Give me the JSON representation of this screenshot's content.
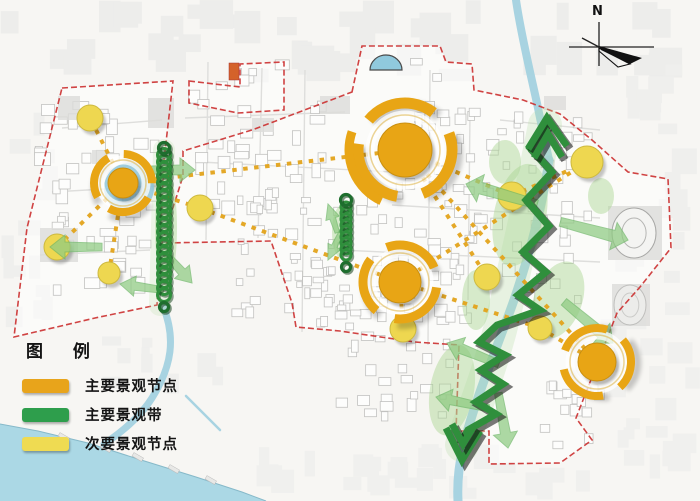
{
  "legend": {
    "title": "图 例",
    "items": [
      {
        "id": "main-landscape-node",
        "label": "主要景观节点",
        "color": "#E8A41B"
      },
      {
        "id": "main-landscape-belt",
        "label": "主要景观带",
        "color": "#2E9E4C"
      },
      {
        "id": "secondary-landscape-node",
        "label": "次要景观节点",
        "color": "#EFDB52"
      }
    ]
  },
  "compass": {
    "label": "N"
  },
  "colors": {
    "main_node": "#E8A515",
    "node_edge": "#C98F10",
    "secondary_node": "#EED750",
    "secondary_edge": "#CDB93E",
    "belt_green": "#2F8F3C",
    "belt_dark": "#14401C",
    "arrow_green": "#8FCB82",
    "park_green": "#A9D491",
    "connector": "#E3A41C",
    "boundary_red": "#CC3333",
    "water": "#ABD8E5",
    "river": "#9ECFDF",
    "building_stroke": "#C2C2C0",
    "background": "#F7F6F3"
  },
  "map": {
    "main_nodes": [
      {
        "x": 405,
        "y": 150,
        "r": 27,
        "ring_r": 47,
        "ring_w": 11,
        "dash": [
          72,
          26
        ],
        "rot": -20,
        "extra": true
      },
      {
        "x": 123,
        "y": 183,
        "r": 15,
        "ring_r": 29,
        "ring_w": 8,
        "dash": [
          45,
          16
        ],
        "rot": 30,
        "water_backing": true
      },
      {
        "x": 400,
        "y": 282,
        "r": 21,
        "ring_r": 37,
        "ring_w": 9,
        "dash": [
          57,
          20
        ],
        "rot": 10
      },
      {
        "x": 597,
        "y": 362,
        "r": 19,
        "ring_r": 34,
        "ring_w": 8,
        "dash": [
          52,
          19
        ],
        "rot": -40
      }
    ],
    "secondary_nodes": [
      [
        90,
        118,
        13
      ],
      [
        57,
        247,
        13
      ],
      [
        109,
        273,
        11
      ],
      [
        200,
        208,
        13
      ],
      [
        512,
        196,
        14
      ],
      [
        487,
        277,
        13
      ],
      [
        540,
        328,
        12
      ],
      [
        587,
        162,
        16
      ],
      [
        403,
        329,
        13
      ]
    ],
    "connectors": [
      [
        123,
        183,
        405,
        150
      ],
      [
        123,
        183,
        90,
        118
      ],
      [
        123,
        183,
        57,
        247
      ],
      [
        123,
        183,
        109,
        273
      ],
      [
        123,
        183,
        200,
        208
      ],
      [
        200,
        208,
        400,
        282
      ],
      [
        405,
        150,
        512,
        196
      ],
      [
        512,
        196,
        587,
        162
      ],
      [
        405,
        150,
        597,
        362
      ],
      [
        405,
        150,
        487,
        277
      ],
      [
        400,
        282,
        587,
        162
      ],
      [
        400,
        282,
        540,
        328
      ],
      [
        540,
        328,
        597,
        362
      ],
      [
        400,
        282,
        403,
        329
      ]
    ],
    "coils": [
      {
        "x": 164,
        "y0": 155,
        "y1": 300,
        "r": 6.5,
        "step": 7
      },
      {
        "x": 346,
        "y0": 207,
        "y1": 260,
        "r": 5,
        "step": 6
      }
    ],
    "zigzag": {
      "points": [
        [
          548,
          122
        ],
        [
          530,
          148
        ],
        [
          552,
          172
        ],
        [
          526,
          200
        ],
        [
          549,
          226
        ],
        [
          523,
          252
        ],
        [
          546,
          272
        ],
        [
          518,
          295
        ],
        [
          540,
          310
        ],
        [
          497,
          325
        ],
        [
          479,
          342
        ],
        [
          505,
          355
        ],
        [
          481,
          370
        ],
        [
          503,
          384
        ],
        [
          476,
          402
        ],
        [
          496,
          414
        ],
        [
          468,
          430
        ],
        [
          460,
          444
        ]
      ],
      "head_top": [
        [
          [
            528,
            149
          ],
          [
            547,
            118
          ],
          [
            567,
            146
          ]
        ],
        [
          [
            534,
            158
          ],
          [
            548,
            134
          ],
          [
            562,
            157
          ]
        ]
      ],
      "head_bottom": [
        [
          [
            446,
            428
          ],
          [
            462,
            460
          ],
          [
            480,
            431
          ]
        ],
        [
          [
            452,
            424
          ],
          [
            463,
            444
          ],
          [
            474,
            426
          ]
        ]
      ]
    },
    "green_bands": [
      {
        "d": "M545,125 C530,200 515,270 500,330 C485,385 470,420 462,445",
        "w": 34,
        "o": 0.28
      },
      {
        "d": "M164,150 L160,305",
        "w": 22,
        "o": 0.22
      }
    ],
    "arrows": [
      [
        195,
        170,
        0,
        48,
        12
      ],
      [
        50,
        247,
        180,
        52,
        12
      ],
      [
        192,
        283,
        48,
        40,
        10
      ],
      [
        120,
        284,
        188,
        44,
        10
      ],
      [
        328,
        204,
        252,
        30,
        7
      ],
      [
        328,
        260,
        115,
        30,
        7
      ],
      [
        466,
        184,
        196,
        74,
        14
      ],
      [
        628,
        240,
        15,
        70,
        14
      ],
      [
        447,
        343,
        202,
        56,
        12
      ],
      [
        613,
        343,
        40,
        64,
        13
      ],
      [
        436,
        397,
        192,
        54,
        11
      ],
      [
        508,
        448,
        80,
        56,
        12
      ]
    ],
    "parks": [
      [
        520,
        215,
        26,
        52,
        12
      ],
      [
        558,
        300,
        24,
        40,
        20
      ],
      [
        452,
        390,
        22,
        46,
        10
      ],
      [
        505,
        162,
        16,
        22,
        0
      ],
      [
        341,
        232,
        9,
        26,
        0
      ],
      [
        166,
        228,
        11,
        58,
        0
      ],
      [
        601,
        196,
        13,
        18,
        0
      ],
      [
        476,
        300,
        14,
        30,
        0
      ]
    ],
    "rivers": [
      {
        "d": "M516,0 C521,35 531,75 538,108 C542,128 546,145 549,160",
        "w": 8
      },
      {
        "d": "M549,160 C541,215 527,262 514,300 C500,340 478,392 466,436 C459,462 457,480 458,501",
        "w": 9
      },
      {
        "d": "M163,306 C176,338 172,366 152,398 C140,417 122,432 104,444",
        "w": 7
      },
      {
        "d": "M186,396 L220,430",
        "w": 2.5
      }
    ],
    "water_body": "M0,424 L38,431 L88,443 L138,459 L196,477 L242,492 L266,501 L0,501 Z",
    "shoreline": "M0,424 L38,431 L88,443 L138,459 L196,477 L242,492 L266,501",
    "piers": [
      [
        58,
        436
      ],
      [
        100,
        447
      ],
      [
        132,
        456
      ],
      [
        168,
        468
      ],
      [
        205,
        479
      ]
    ],
    "boundaries": [
      "M62,88 L173,81 L164,160 L157,305 L95,318 L14,337 L27,228 Z",
      "M189,81 L240,87 L240,64 L284,62 L284,110 L238,113 L189,103 Z",
      "M352,92 L362,46 L440,46 L446,62 L472,64 L474,90 L523,100 L560,114 L592,140 L628,172 L668,179 L671,248 L640,287 L617,313 L576,418 L592,440 L560,463 L489,464 L489,431 L456,431 L459,345 L415,342 L340,331 L296,327 L292,303 L271,241 L162,243 L183,176 L183,151 L252,130 Z"
    ],
    "gray_patches": [
      [
        40,
        228,
        38,
        34
      ],
      [
        148,
        98,
        26,
        30
      ],
      [
        58,
        96,
        22,
        24
      ],
      [
        544,
        96,
        22,
        14
      ],
      [
        92,
        150,
        16,
        14
      ],
      [
        252,
        118,
        22,
        14
      ],
      [
        608,
        206,
        54,
        54
      ],
      [
        612,
        284,
        38,
        42
      ],
      [
        320,
        96,
        30,
        18
      ]
    ],
    "stadiums": [
      {
        "cx": 634,
        "cy": 233,
        "rx": 22,
        "ry": 25
      },
      {
        "cx": 630,
        "cy": 305,
        "rx": 16,
        "ry": 20
      }
    ],
    "pond": {
      "cx": 386,
      "cy": 70,
      "rx": 16,
      "ry": 15
    },
    "red_mark": [
      229,
      63,
      10,
      17
    ],
    "roads": [
      [
        62,
        128,
        162,
        120
      ],
      [
        52,
        192,
        158,
        186
      ],
      [
        40,
        255,
        150,
        250
      ],
      [
        185,
        118,
        345,
        112
      ],
      [
        208,
        62,
        206,
        240
      ],
      [
        262,
        68,
        258,
        238
      ],
      [
        305,
        70,
        302,
        332
      ],
      [
        430,
        70,
        428,
        345
      ],
      [
        392,
        205,
        600,
        218
      ],
      [
        470,
        112,
        468,
        300
      ],
      [
        200,
        162,
        392,
        172
      ],
      [
        340,
        250,
        600,
        262
      ],
      [
        500,
        120,
        600,
        130
      ]
    ],
    "building_zones": [
      {
        "x": 32,
        "y": 92,
        "w": 128,
        "h": 210,
        "n": 48,
        "s": [
          7,
          16
        ]
      },
      {
        "x": 185,
        "y": 58,
        "w": 150,
        "h": 185,
        "n": 40,
        "s": [
          7,
          15
        ]
      },
      {
        "x": 230,
        "y": 185,
        "w": 160,
        "h": 145,
        "n": 60,
        "s": [
          5,
          11
        ]
      },
      {
        "x": 390,
        "y": 58,
        "w": 85,
        "h": 290,
        "n": 42,
        "s": [
          6,
          13
        ]
      },
      {
        "x": 462,
        "y": 108,
        "w": 140,
        "h": 200,
        "n": 46,
        "s": [
          6,
          13
        ]
      },
      {
        "x": 332,
        "y": 300,
        "w": 130,
        "h": 125,
        "n": 30,
        "s": [
          6,
          13
        ]
      },
      {
        "x": 538,
        "y": 380,
        "w": 75,
        "h": 80,
        "n": 14,
        "s": [
          7,
          14
        ]
      }
    ],
    "outside_zones": [
      {
        "x": 0,
        "y": 0,
        "w": 700,
        "h": 84,
        "n": 42,
        "s": [
          12,
          34
        ],
        "fill": "#EDEDEB"
      },
      {
        "x": 615,
        "y": 60,
        "w": 85,
        "h": 240,
        "n": 20,
        "s": [
          10,
          26
        ],
        "fill": "#EFEFED"
      },
      {
        "x": 0,
        "y": 86,
        "w": 58,
        "h": 250,
        "n": 14,
        "s": [
          10,
          24
        ],
        "fill": "#EFEFED"
      },
      {
        "x": 600,
        "y": 300,
        "w": 100,
        "h": 200,
        "n": 22,
        "s": [
          10,
          26
        ],
        "fill": "#F0F0EE"
      },
      {
        "x": 255,
        "y": 430,
        "w": 340,
        "h": 70,
        "n": 26,
        "s": [
          10,
          26
        ],
        "fill": "#F0F0EE"
      },
      {
        "x": 60,
        "y": 330,
        "w": 180,
        "h": 80,
        "n": 10,
        "s": [
          8,
          20
        ],
        "fill": "#EFEFED"
      }
    ]
  }
}
